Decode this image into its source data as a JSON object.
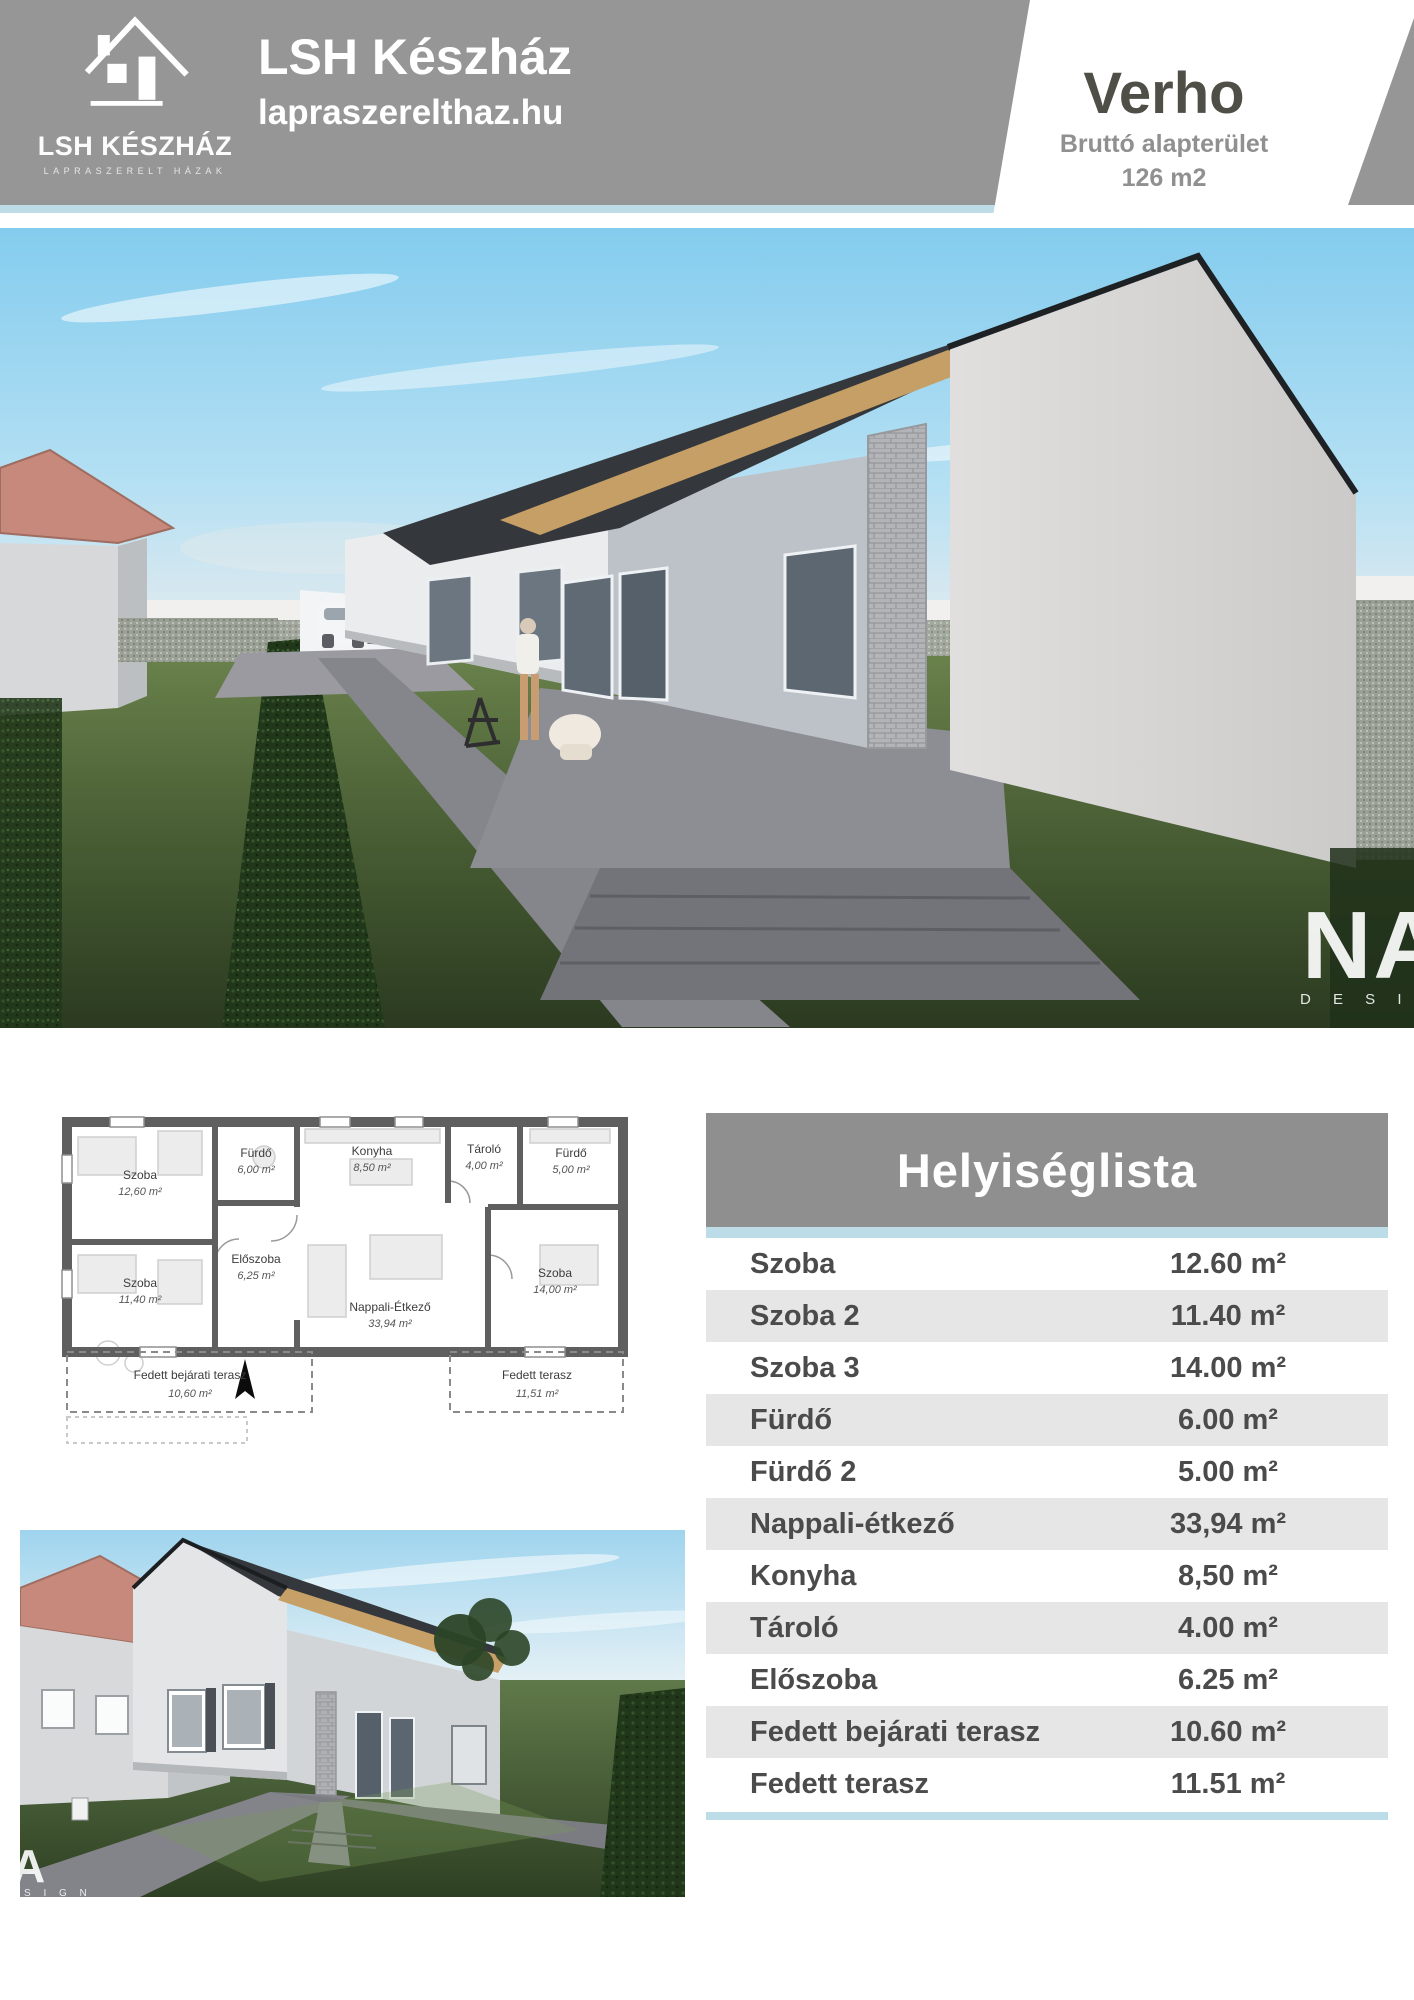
{
  "header": {
    "logo": {
      "icon": "house-icon",
      "brand": "LSH KÉSZHÁZ",
      "tagline": "LAPRASZERELT HÁZAK"
    },
    "title": "LSH Készház",
    "subtitle": "lapraszerelthaz.hu",
    "badge": {
      "model": "Verho",
      "label": "Bruttó alapterület",
      "value": "126 m2"
    }
  },
  "colors": {
    "header_gray": "#969696",
    "accent_blue": "#bcdde7",
    "table_header_gray": "#8f8f8f",
    "row_alt_gray": "#e6e6e6",
    "table_text": "#4b4b4b",
    "badge_text": "#4f4f48",
    "neighbor_roof_salmon": "#c6897b"
  },
  "main_render": {
    "watermark_monogram": "NA",
    "watermark_text": "D E S I G N"
  },
  "second_render": {
    "watermark_monogram": "A",
    "watermark_text": "S I G N"
  },
  "floor_plan": {
    "rooms": [
      {
        "name": "Szoba",
        "area": "12,60 m²"
      },
      {
        "name": "Fürdő",
        "area": "6,00 m²"
      },
      {
        "name": "Konyha",
        "area": "8,50 m²"
      },
      {
        "name": "Tároló",
        "area": "4,00 m²"
      },
      {
        "name": "Fürdő",
        "area": "5,00 m²"
      },
      {
        "name": "Szoba",
        "area": "11,40 m²"
      },
      {
        "name": "Előszoba",
        "area": "6,25 m²"
      },
      {
        "name": "Nappali-Étkező",
        "area": "33,94 m²"
      },
      {
        "name": "Szoba",
        "area": "14,00 m²"
      },
      {
        "name": "Fedett bejárati terasz",
        "area": "10,60 m²"
      },
      {
        "name": "Fedett terasz",
        "area": "11,51 m²"
      }
    ]
  },
  "room_table": {
    "title": "Helyiséglista",
    "rows": [
      {
        "name": "Szoba",
        "value": "12.60 m²"
      },
      {
        "name": "Szoba 2",
        "value": "11.40 m²"
      },
      {
        "name": "Szoba 3",
        "value": "14.00 m²"
      },
      {
        "name": "Fürdő",
        "value": "6.00 m²"
      },
      {
        "name": "Fürdő 2",
        "value": "5.00 m²"
      },
      {
        "name": "Nappali-étkező",
        "value": "33,94 m²"
      },
      {
        "name": "Konyha",
        "value": "8,50 m²"
      },
      {
        "name": "Tároló",
        "value": "4.00 m²"
      },
      {
        "name": "Előszoba",
        "value": "6.25 m²"
      },
      {
        "name": "Fedett bejárati terasz",
        "value": "10.60 m²"
      },
      {
        "name": "Fedett terasz",
        "value": "11.51 m²"
      }
    ]
  }
}
